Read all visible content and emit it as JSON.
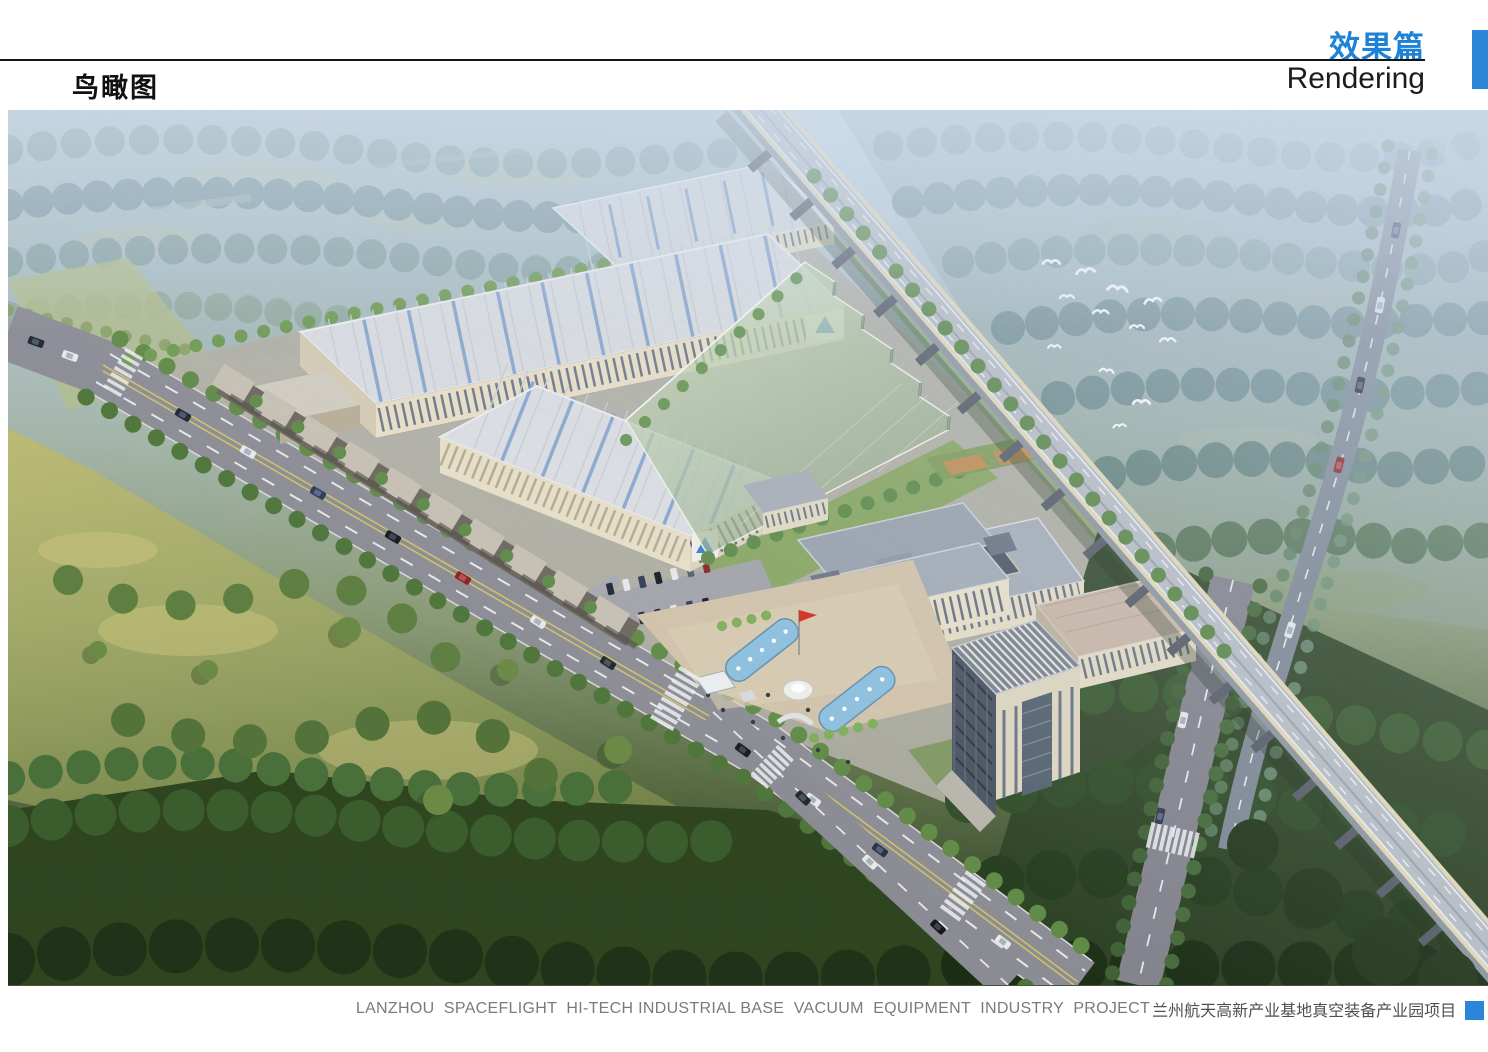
{
  "header": {
    "section_title_zh": "效果篇",
    "section_title_en": "Rendering",
    "page_title_zh": "鸟瞰图"
  },
  "footer": {
    "caption_en": "LANZHOU  SPACEFLIGHT  HI-TECH INDUSTRIAL BASE  VACUUM  EQUIPMENT  INDUSTRY  PROJECT",
    "caption_zh": "兰州航天高新产业基地真空装备产业园项目"
  },
  "colors": {
    "accent_blue": "#2b85d8"
  }
}
